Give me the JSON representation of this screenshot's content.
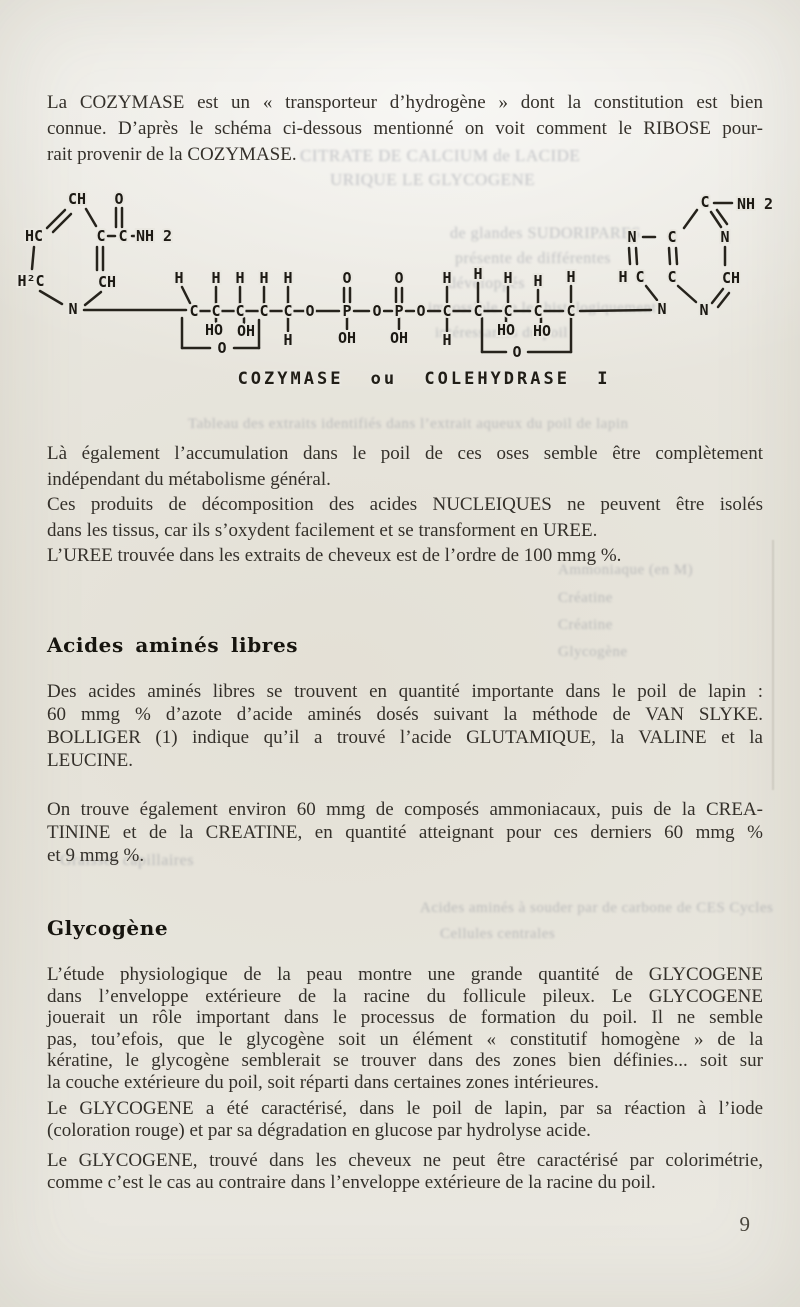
{
  "page": {
    "number": "9"
  },
  "headings": {
    "h1": "Acides aminés libres",
    "h2": "Glycogène"
  },
  "paragraphs": {
    "p1": {
      "lines": [
        "La COZYMASE est un « transporteur d’hydrogène » dont la constitution est bien",
        "connue. D’après le schéma ci-dessous mentionné on voit comment le RIBOSE pour-",
        "rait provenir de la COZYMASE."
      ]
    },
    "p2": {
      "lines": [
        "Là également l’accumulation dans le poil de ces oses semble être complètement",
        "indépendant du métabolisme général."
      ]
    },
    "p3": {
      "lines": [
        "Ces produits de décomposition des acides NUCLEIQUES ne peuvent être isolés",
        "dans les tissus, car ils s’oxydent facilement et se transforment en UREE."
      ]
    },
    "p4": {
      "lines": [
        "L’UREE trouvée dans les extraits de cheveux est de l’ordre de 100 mmg %."
      ]
    },
    "p5": {
      "lines": [
        "Des acides aminés libres se trouvent en quantité importante dans le poil de lapin :",
        "60 mmg % d’azote d’acide aminés dosés suivant la méthode de VAN SLYKE.",
        "BOLLIGER (1) indique qu’il a trouvé l’acide GLUTAMIQUE, la VALINE et la",
        "LEUCINE."
      ]
    },
    "p6": {
      "lines": [
        "On trouve également environ 60 mmg de composés ammoniacaux, puis de la CREA-",
        "TININE et de la CREATINE, en quantité atteignant pour ces derniers 60 mmg %",
        "et 9 mmg %."
      ]
    },
    "p7": {
      "lines": [
        "L’étude physiologique de la peau montre une grande quantité de GLYCOGENE",
        "dans l’enveloppe extérieure de la racine du follicule pileux. Le GLYCOGENE",
        "jouerait un rôle important dans le processus de formation du poil. Il ne semble",
        "pas, tou’efois, que le glycogène soit un élément « constitutif homogène » de la",
        "kératine, le glycogène semblerait se trouver dans des zones bien définies... soit sur",
        "la couche extérieure du poil, soit réparti dans certaines zones intérieures."
      ]
    },
    "p8": {
      "lines": [
        "Le GLYCOGENE a été caractérisé, dans le poil de lapin, par sa réaction à l’iode",
        "(coloration rouge) et par sa dégradation en glucose par hydrolyse acide."
      ]
    },
    "p9": {
      "lines": [
        "Le GLYCOGENE, trouvé dans les cheveux ne peut être caractérisé par colorimétrie,",
        "comme c’est le cas au contraire dans l’enveloppe extérieure de la racine du poil."
      ]
    }
  },
  "diagram": {
    "caption": "COZYMASE ou COLEHYDRASE I",
    "atoms": [
      {
        "t": "CH",
        "x": 77,
        "y": 199
      },
      {
        "t": "O",
        "x": 119,
        "y": 199
      },
      {
        "t": "HC",
        "x": 34,
        "y": 236
      },
      {
        "t": "C",
        "x": 101,
        "y": 236
      },
      {
        "t": "C",
        "x": 123,
        "y": 236
      },
      {
        "t": "NH 2",
        "x": 154,
        "y": 236
      },
      {
        "t": "H²C",
        "x": 31,
        "y": 281
      },
      {
        "t": "CH",
        "x": 107,
        "y": 282
      },
      {
        "t": "N",
        "x": 73,
        "y": 309
      },
      {
        "t": "H",
        "x": 179,
        "y": 278
      },
      {
        "t": "H",
        "x": 216,
        "y": 278
      },
      {
        "t": "H",
        "x": 240,
        "y": 278
      },
      {
        "t": "H",
        "x": 264,
        "y": 278
      },
      {
        "t": "H",
        "x": 288,
        "y": 278
      },
      {
        "t": "C",
        "x": 194,
        "y": 311
      },
      {
        "t": "C",
        "x": 216,
        "y": 311
      },
      {
        "t": "C",
        "x": 240,
        "y": 311
      },
      {
        "t": "C",
        "x": 264,
        "y": 311
      },
      {
        "t": "C",
        "x": 288,
        "y": 311
      },
      {
        "t": "O",
        "x": 310,
        "y": 311
      },
      {
        "t": "HO",
        "x": 214,
        "y": 330
      },
      {
        "t": "OH",
        "x": 246,
        "y": 331
      },
      {
        "t": "H",
        "x": 288,
        "y": 340
      },
      {
        "t": "O",
        "x": 222,
        "y": 348
      },
      {
        "t": "O",
        "x": 347,
        "y": 278
      },
      {
        "t": "P",
        "x": 347,
        "y": 311
      },
      {
        "t": "OH",
        "x": 347,
        "y": 338
      },
      {
        "t": "O",
        "x": 377,
        "y": 311
      },
      {
        "t": "O",
        "x": 399,
        "y": 278
      },
      {
        "t": "P",
        "x": 399,
        "y": 311
      },
      {
        "t": "OH",
        "x": 399,
        "y": 338
      },
      {
        "t": "O",
        "x": 421,
        "y": 311
      },
      {
        "t": "H",
        "x": 447,
        "y": 278
      },
      {
        "t": "H",
        "x": 478,
        "y": 274
      },
      {
        "t": "H",
        "x": 508,
        "y": 278
      },
      {
        "t": "H",
        "x": 538,
        "y": 281
      },
      {
        "t": "H",
        "x": 571,
        "y": 277
      },
      {
        "t": "C",
        "x": 447,
        "y": 311
      },
      {
        "t": "C",
        "x": 478,
        "y": 311
      },
      {
        "t": "C",
        "x": 508,
        "y": 311
      },
      {
        "t": "C",
        "x": 538,
        "y": 311
      },
      {
        "t": "C",
        "x": 571,
        "y": 311
      },
      {
        "t": "H",
        "x": 447,
        "y": 340
      },
      {
        "t": "HO",
        "x": 506,
        "y": 330
      },
      {
        "t": "HO",
        "x": 542,
        "y": 331
      },
      {
        "t": "O",
        "x": 517,
        "y": 352
      },
      {
        "t": "C",
        "x": 705,
        "y": 202
      },
      {
        "t": "NH 2",
        "x": 755,
        "y": 204
      },
      {
        "t": "N",
        "x": 632,
        "y": 237
      },
      {
        "t": "C",
        "x": 672,
        "y": 237
      },
      {
        "t": "N",
        "x": 725,
        "y": 237
      },
      {
        "t": "H",
        "x": 623,
        "y": 277
      },
      {
        "t": "C",
        "x": 640,
        "y": 277
      },
      {
        "t": "C",
        "x": 672,
        "y": 277
      },
      {
        "t": "CH",
        "x": 731,
        "y": 278
      },
      {
        "t": "N",
        "x": 662,
        "y": 309
      },
      {
        "t": "N",
        "x": 704,
        "y": 310
      }
    ],
    "bonds": [
      [
        65,
        210,
        47,
        228
      ],
      [
        71,
        214,
        53,
        232
      ],
      [
        86,
        209,
        96,
        226
      ],
      [
        116,
        208,
        116,
        227
      ],
      [
        122,
        208,
        122,
        227
      ],
      [
        108,
        236,
        115,
        236
      ],
      [
        132,
        236,
        139,
        236
      ],
      [
        97,
        247,
        97,
        270
      ],
      [
        103,
        247,
        103,
        270
      ],
      [
        34,
        247,
        32,
        269
      ],
      [
        40,
        291,
        62,
        304
      ],
      [
        101,
        292,
        85,
        305
      ],
      [
        84,
        310,
        186,
        310
      ],
      [
        182,
        287,
        190,
        303
      ],
      [
        216,
        287,
        216,
        303
      ],
      [
        240,
        287,
        240,
        303
      ],
      [
        264,
        287,
        264,
        303
      ],
      [
        288,
        287,
        288,
        303
      ],
      [
        200,
        311,
        210,
        311
      ],
      [
        222,
        311,
        234,
        311
      ],
      [
        246,
        311,
        258,
        311
      ],
      [
        270,
        311,
        282,
        311
      ],
      [
        294,
        311,
        304,
        311
      ],
      [
        316,
        311,
        339,
        311
      ],
      [
        216,
        317,
        216,
        322
      ],
      [
        244,
        318,
        244,
        324
      ],
      [
        288,
        317,
        288,
        331
      ],
      [
        182,
        318,
        182,
        348
      ],
      [
        182,
        348,
        210,
        348
      ],
      [
        234,
        348,
        259,
        348
      ],
      [
        259,
        348,
        259,
        320
      ],
      [
        344,
        288,
        344,
        302
      ],
      [
        350,
        288,
        350,
        302
      ],
      [
        347,
        318,
        347,
        329
      ],
      [
        354,
        311,
        369,
        311
      ],
      [
        384,
        311,
        392,
        311
      ],
      [
        396,
        288,
        396,
        302
      ],
      [
        402,
        288,
        402,
        302
      ],
      [
        399,
        318,
        399,
        329
      ],
      [
        406,
        311,
        414,
        311
      ],
      [
        428,
        311,
        440,
        311
      ],
      [
        447,
        287,
        447,
        302
      ],
      [
        478,
        283,
        478,
        302
      ],
      [
        508,
        287,
        508,
        302
      ],
      [
        538,
        290,
        538,
        303
      ],
      [
        571,
        286,
        571,
        302
      ],
      [
        447,
        318,
        447,
        331
      ],
      [
        453,
        311,
        470,
        311
      ],
      [
        484,
        311,
        501,
        311
      ],
      [
        514,
        311,
        530,
        311
      ],
      [
        544,
        311,
        563,
        311
      ],
      [
        506,
        317,
        506,
        322
      ],
      [
        541,
        318,
        541,
        324
      ],
      [
        482,
        318,
        482,
        352
      ],
      [
        482,
        352,
        506,
        352
      ],
      [
        528,
        352,
        571,
        352
      ],
      [
        571,
        352,
        571,
        318
      ],
      [
        580,
        311,
        651,
        310
      ],
      [
        714,
        203,
        732,
        203
      ],
      [
        711,
        212,
        721,
        227
      ],
      [
        717,
        210,
        727,
        224
      ],
      [
        697,
        210,
        684,
        228
      ],
      [
        643,
        237,
        655,
        237
      ],
      [
        629,
        248,
        630,
        264
      ],
      [
        636,
        248,
        637,
        264
      ],
      [
        669,
        248,
        670,
        264
      ],
      [
        676,
        248,
        677,
        264
      ],
      [
        725,
        247,
        725,
        265
      ],
      [
        646,
        286,
        657,
        300
      ],
      [
        678,
        286,
        696,
        302
      ],
      [
        712,
        303,
        723,
        289
      ],
      [
        718,
        307,
        729,
        293
      ]
    ]
  },
  "bleed_through": [
    {
      "t": "CITRATE DE CALCIUM de LACIDE",
      "x": 300,
      "y": 146,
      "s": 17
    },
    {
      "t": "URIQUE LE GLYCOGENE",
      "x": 330,
      "y": 170,
      "s": 17
    },
    {
      "t": "de glandes SUDORIPARES",
      "x": 450,
      "y": 225,
      "s": 16
    },
    {
      "t": "présente de différentes",
      "x": 455,
      "y": 250,
      "s": 16
    },
    {
      "t": "développés",
      "x": 448,
      "y": 275,
      "s": 16
    },
    {
      "t": "impossible de les histologiquement",
      "x": 428,
      "y": 300,
      "s": 15
    },
    {
      "t": "intéressantes du poil",
      "x": 435,
      "y": 325,
      "s": 15
    },
    {
      "t": "Tableau des extraits identifiés dans l’extrait aqueux du poil de lapin",
      "x": 188,
      "y": 416,
      "s": 15
    },
    {
      "t": "Ammoniaque (en M)",
      "x": 558,
      "y": 562,
      "s": 15
    },
    {
      "t": "Créatine",
      "x": 558,
      "y": 590,
      "s": 15
    },
    {
      "t": "Créatine",
      "x": 558,
      "y": 617,
      "s": 15
    },
    {
      "t": "Glycogène",
      "x": 558,
      "y": 644,
      "s": 15
    },
    {
      "t": "Graisses capillaires",
      "x": 60,
      "y": 852,
      "s": 16
    },
    {
      "t": "Acides aminés à souder par de carbone de CES Cycles",
      "x": 420,
      "y": 900,
      "s": 15
    },
    {
      "t": "Cellules centrales",
      "x": 440,
      "y": 926,
      "s": 15
    }
  ]
}
